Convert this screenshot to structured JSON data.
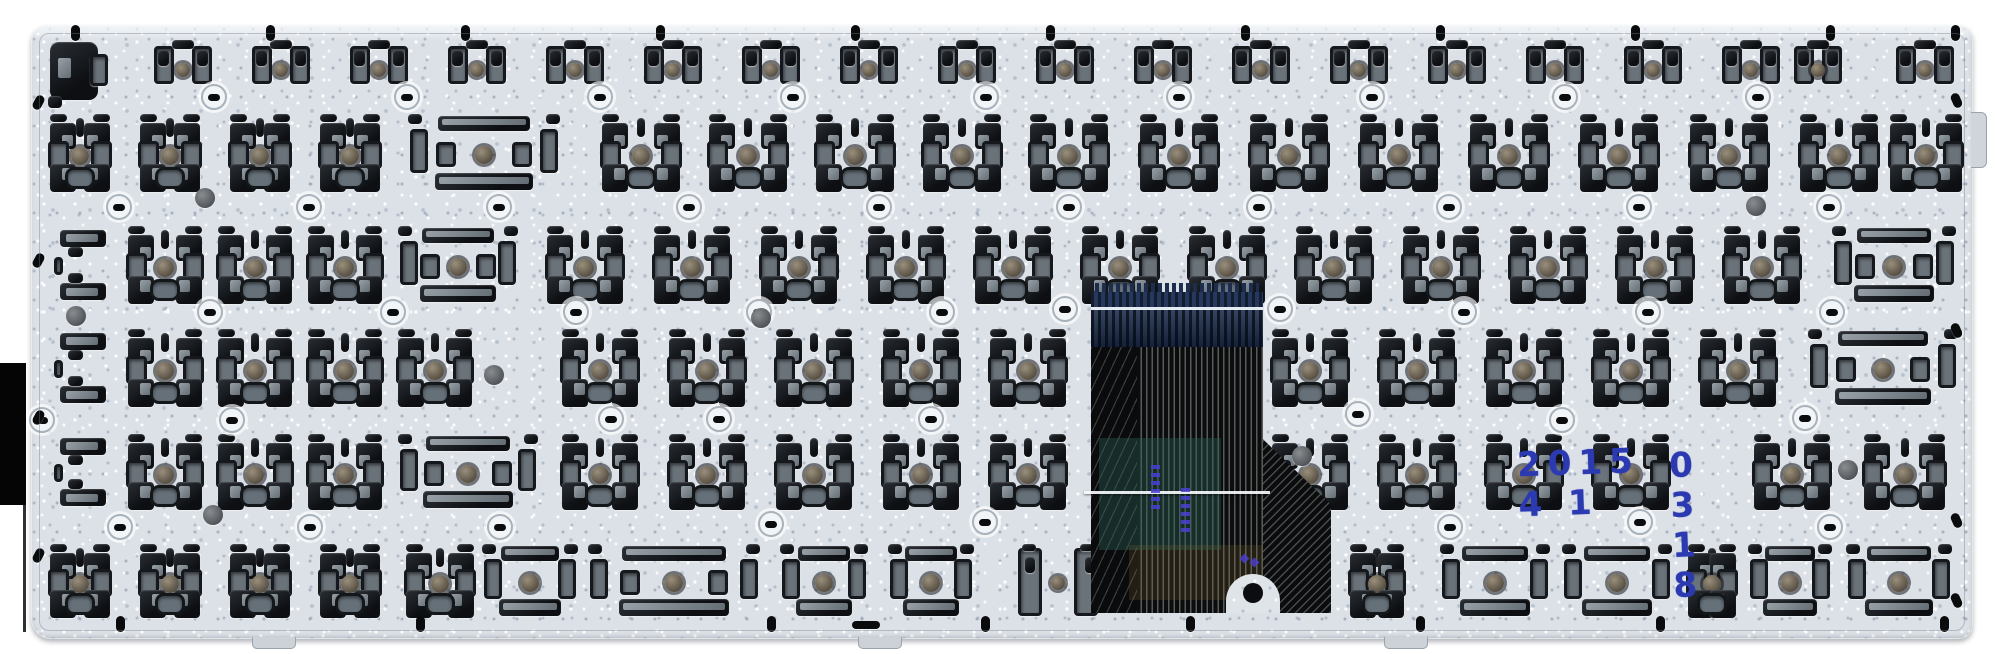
{
  "meta": {
    "description": "Photograph of the metal back plate of a laptop keyboard with key-mount clip clusters, screw bosses, a folded flex ribbon cable and a handwritten blue date stamp",
    "background_color": "#ffffff"
  },
  "colors": {
    "plate": "#dce1e7",
    "slot_dark": "#15181c",
    "slot_gray": "#6a727a",
    "center_dot": "#6f675a",
    "ribbon_blue": "#1b2c4c",
    "ribbon_black": "#0b0c0e",
    "ink_blue": "#2c3ab2",
    "print_purple": "#4b3fd4"
  },
  "stamp": {
    "left": "2015 4 1",
    "right": "0 3 1 8"
  },
  "plate": {
    "x": 31,
    "y": 25,
    "w": 1942,
    "h": 614,
    "rows": [
      {
        "y": 40,
        "h": 50,
        "cells": [
          [
            48,
            62,
            "esc"
          ],
          [
            150,
            66,
            "A"
          ],
          [
            248,
            66,
            "A"
          ],
          [
            346,
            66,
            "A"
          ],
          [
            444,
            66,
            "A"
          ],
          [
            542,
            66,
            "A"
          ],
          [
            640,
            66,
            "A"
          ],
          [
            738,
            66,
            "A"
          ],
          [
            836,
            66,
            "A"
          ],
          [
            934,
            66,
            "A"
          ],
          [
            1032,
            66,
            "A"
          ],
          [
            1130,
            66,
            "A"
          ],
          [
            1228,
            66,
            "A"
          ],
          [
            1326,
            66,
            "A"
          ],
          [
            1424,
            66,
            "A"
          ],
          [
            1522,
            66,
            "A"
          ],
          [
            1620,
            66,
            "A"
          ],
          [
            1718,
            66,
            "A"
          ],
          [
            1790,
            56,
            "A"
          ],
          [
            1892,
            66,
            "A"
          ]
        ]
      },
      {
        "y": 114,
        "h": 80,
        "cells": [
          [
            48,
            64,
            "B"
          ],
          [
            138,
            64,
            "B"
          ],
          [
            228,
            64,
            "B"
          ],
          [
            318,
            64,
            "B"
          ],
          [
            408,
            152,
            "C"
          ],
          [
            600,
            82,
            "B"
          ],
          [
            707,
            82,
            "B"
          ],
          [
            814,
            82,
            "B"
          ],
          [
            921,
            82,
            "B"
          ],
          [
            1028,
            82,
            "B"
          ],
          [
            1138,
            82,
            "B"
          ],
          [
            1248,
            82,
            "B"
          ],
          [
            1358,
            82,
            "B"
          ],
          [
            1468,
            82,
            "B"
          ],
          [
            1578,
            82,
            "B"
          ],
          [
            1688,
            82,
            "B"
          ],
          [
            1798,
            82,
            "B"
          ],
          [
            1888,
            76,
            "B"
          ]
        ]
      },
      {
        "y": 226,
        "h": 80,
        "cells": [
          [
            54,
            58,
            "F"
          ],
          [
            126,
            78,
            "B"
          ],
          [
            216,
            78,
            "B"
          ],
          [
            306,
            78,
            "B"
          ],
          [
            398,
            120,
            "C"
          ],
          [
            545,
            80,
            "B"
          ],
          [
            652,
            80,
            "B"
          ],
          [
            759,
            80,
            "B"
          ],
          [
            866,
            80,
            "B"
          ],
          [
            973,
            80,
            "B"
          ],
          [
            1080,
            80,
            "B"
          ],
          [
            1187,
            80,
            "B"
          ],
          [
            1294,
            80,
            "B"
          ],
          [
            1401,
            80,
            "B"
          ],
          [
            1508,
            80,
            "B"
          ],
          [
            1615,
            80,
            "B"
          ],
          [
            1722,
            80,
            "B"
          ],
          [
            1832,
            124,
            "C"
          ]
        ]
      },
      {
        "y": 329,
        "h": 80,
        "cells": [
          [
            54,
            58,
            "F"
          ],
          [
            126,
            78,
            "B"
          ],
          [
            216,
            78,
            "B"
          ],
          [
            306,
            78,
            "B"
          ],
          [
            396,
            78,
            "B"
          ],
          [
            560,
            80,
            "B"
          ],
          [
            667,
            80,
            "B"
          ],
          [
            774,
            80,
            "B"
          ],
          [
            881,
            80,
            "B"
          ],
          [
            988,
            80,
            "B"
          ],
          [
            1270,
            80,
            "B"
          ],
          [
            1377,
            80,
            "B"
          ],
          [
            1484,
            80,
            "B"
          ],
          [
            1591,
            80,
            "B"
          ],
          [
            1698,
            80,
            "B"
          ],
          [
            1808,
            150,
            "C"
          ]
        ]
      },
      {
        "y": 434,
        "h": 78,
        "cells": [
          [
            54,
            58,
            "F"
          ],
          [
            126,
            78,
            "B"
          ],
          [
            216,
            78,
            "B"
          ],
          [
            306,
            78,
            "B"
          ],
          [
            398,
            140,
            "C"
          ],
          [
            560,
            80,
            "B"
          ],
          [
            667,
            80,
            "B"
          ],
          [
            774,
            80,
            "B"
          ],
          [
            881,
            80,
            "B"
          ],
          [
            988,
            80,
            "B"
          ],
          [
            1270,
            80,
            "B"
          ],
          [
            1377,
            80,
            "B"
          ],
          [
            1484,
            80,
            "B"
          ],
          [
            1591,
            80,
            "B"
          ],
          [
            1752,
            80,
            "B"
          ],
          [
            1862,
            85,
            "B"
          ]
        ]
      },
      {
        "y": 544,
        "h": 76,
        "cells": [
          [
            48,
            64,
            "B"
          ],
          [
            138,
            64,
            "B"
          ],
          [
            228,
            64,
            "B"
          ],
          [
            318,
            64,
            "B"
          ],
          [
            404,
            72,
            "B"
          ],
          [
            482,
            96,
            "C"
          ],
          [
            588,
            172,
            "C"
          ],
          [
            780,
            88,
            "C"
          ],
          [
            888,
            86,
            "C"
          ],
          [
            1012,
            92,
            "E"
          ],
          [
            1348,
            58,
            "B"
          ],
          [
            1440,
            110,
            "C"
          ],
          [
            1562,
            110,
            "C"
          ],
          [
            1686,
            52,
            "B"
          ],
          [
            1748,
            84,
            "C"
          ],
          [
            1846,
            106,
            "C"
          ]
        ]
      }
    ],
    "rings": [
      [
        214,
        97
      ],
      [
        407,
        97
      ],
      [
        600,
        97
      ],
      [
        793,
        97
      ],
      [
        986,
        97
      ],
      [
        1179,
        97
      ],
      [
        1372,
        97
      ],
      [
        1565,
        97
      ],
      [
        1758,
        97
      ],
      [
        119,
        207
      ],
      [
        309,
        207
      ],
      [
        499,
        207
      ],
      [
        689,
        207
      ],
      [
        879,
        207
      ],
      [
        1069,
        207
      ],
      [
        1259,
        207
      ],
      [
        1449,
        207
      ],
      [
        1639,
        207
      ],
      [
        1829,
        207
      ],
      [
        210,
        312
      ],
      [
        393,
        312
      ],
      [
        576,
        312
      ],
      [
        759,
        312
      ],
      [
        942,
        312
      ],
      [
        1065,
        309
      ],
      [
        1280,
        309
      ],
      [
        1464,
        312
      ],
      [
        1648,
        312
      ],
      [
        1832,
        312
      ],
      [
        42,
        420
      ],
      [
        232,
        420
      ],
      [
        611,
        419
      ],
      [
        719,
        419
      ],
      [
        931,
        419
      ],
      [
        1358,
        414
      ],
      [
        1562,
        420
      ],
      [
        1805,
        418
      ],
      [
        120,
        527
      ],
      [
        310,
        527
      ],
      [
        500,
        527
      ],
      [
        771,
        524
      ],
      [
        985,
        522
      ],
      [
        1190,
        525
      ],
      [
        1450,
        527
      ],
      [
        1640,
        522
      ],
      [
        1830,
        527
      ]
    ],
    "dots": [
      [
        205,
        198
      ],
      [
        76,
        316
      ],
      [
        494,
        375
      ],
      [
        761,
        318
      ],
      [
        213,
        515
      ],
      [
        1756,
        206
      ],
      [
        1302,
        456
      ],
      [
        1848,
        470
      ]
    ],
    "holes": {
      "top_y": 33,
      "top_x": [
        75,
        270,
        465,
        660,
        855,
        1050,
        1245,
        1440,
        1635,
        1830,
        1955
      ],
      "bottom_y": 624,
      "bottom_x": [
        120,
        420,
        771,
        985,
        1190,
        1420,
        1660,
        1944
      ],
      "bottom_slot_x": 866,
      "left_x": 38,
      "left_y": [
        102,
        260,
        417,
        555
      ],
      "right_x": 1956,
      "right_y": [
        100,
        330,
        520,
        600
      ]
    },
    "tabs_bottom_x": [
      252,
      858,
      1384
    ]
  },
  "cable": {
    "x": 1091,
    "y": 283,
    "w": 172,
    "h": 330,
    "purple_marks": [
      [
        60,
        182,
        48
      ],
      [
        90,
        205,
        46
      ]
    ],
    "purple_tris": [
      [
        150,
        272
      ],
      [
        160,
        276
      ]
    ]
  }
}
